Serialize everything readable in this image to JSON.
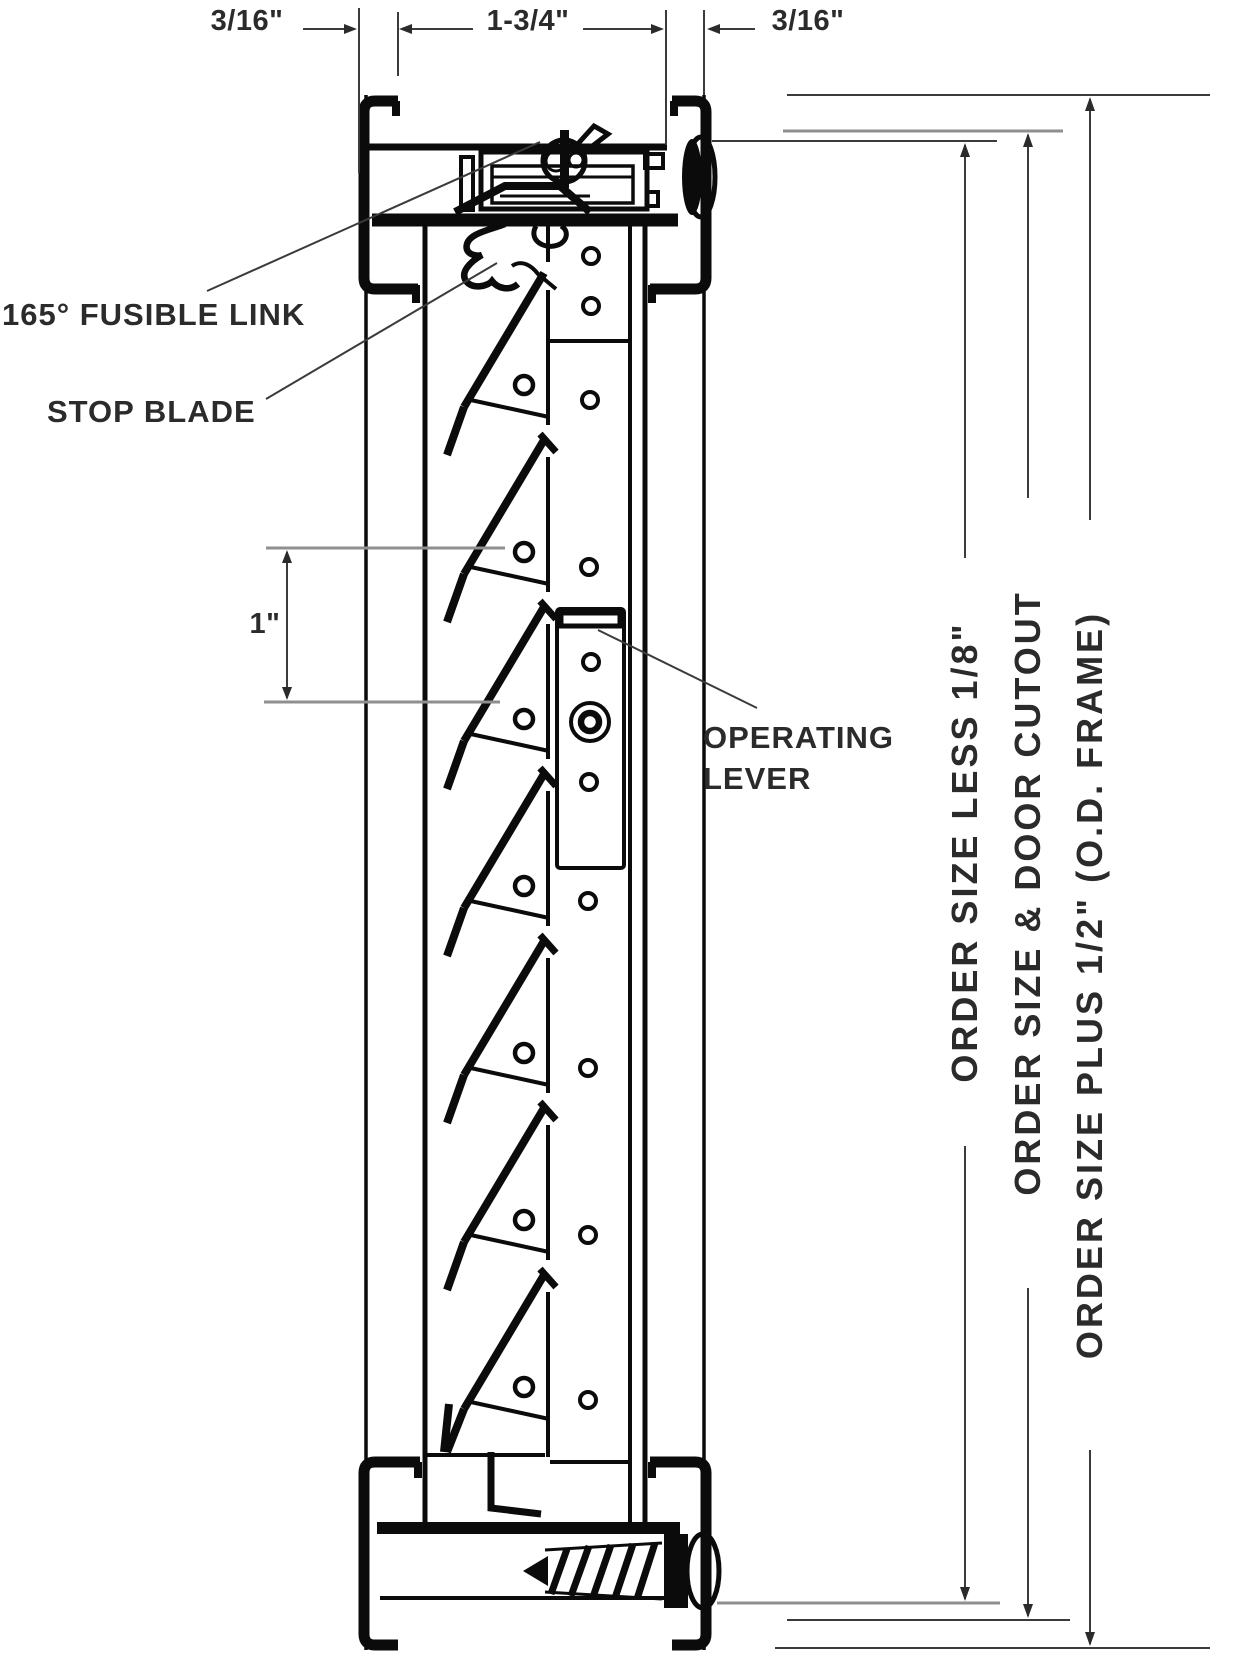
{
  "diagram": {
    "type": "technical-cross-section",
    "subject": "fire damper louver side section",
    "dimensions": {
      "top_left": "3/16\"",
      "top_middle": "1-3/4\"",
      "top_right": "3/16\"",
      "blade_spacing": "1\""
    },
    "labels": {
      "fusible_link": "165° FUSIBLE LINK",
      "stop_blade": "STOP BLADE",
      "operating_lever_line1": "OPERATING",
      "operating_lever_line2": "LEVER"
    },
    "vertical_dimensions": {
      "order_size_less": "ORDER SIZE LESS 1/8\"",
      "order_size_door_cutout": "ORDER SIZE & DOOR CUTOUT",
      "order_size_od_frame": "ORDER SIZE  PLUS 1/2\" (O.D. FRAME)"
    },
    "colors": {
      "artwork_line": "#0b0b0b",
      "dimension_line": "#3b3b3b",
      "extension_line_gray": "#8f8f8f",
      "text": "#2b2b2b",
      "background": "#ffffff"
    }
  }
}
